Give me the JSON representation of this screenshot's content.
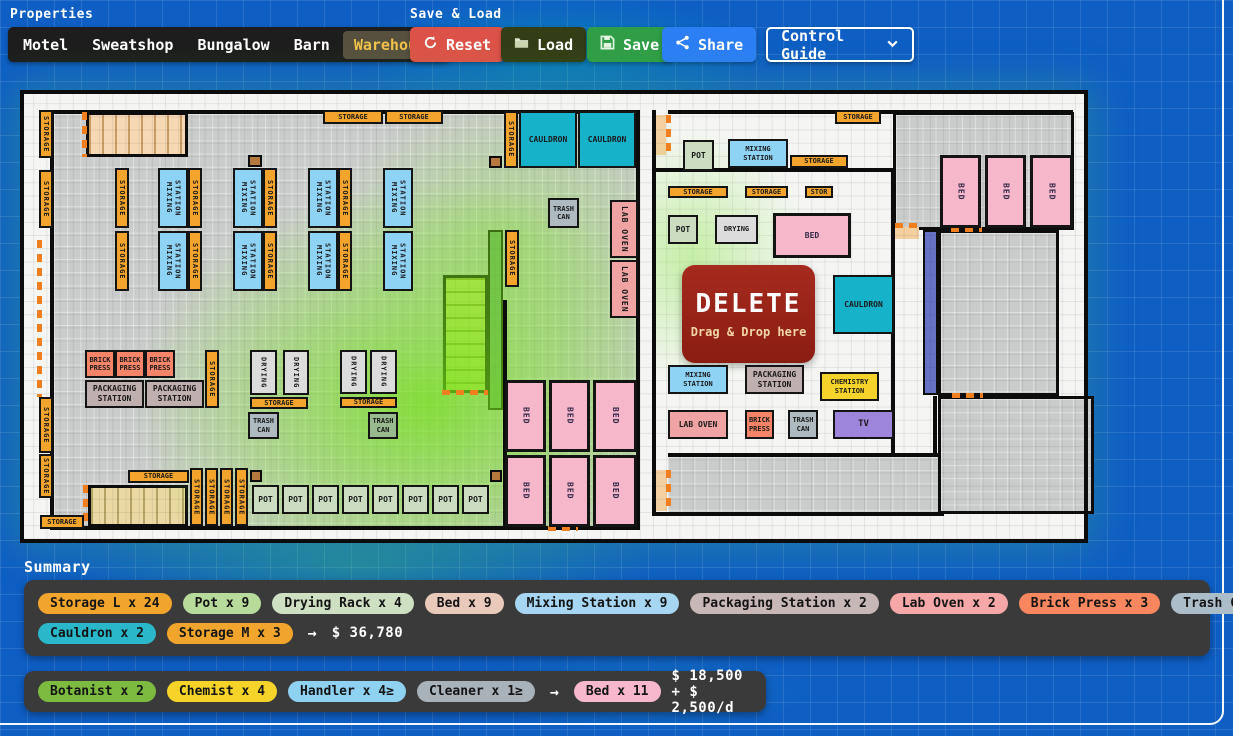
{
  "header": {
    "properties_label": "Properties",
    "save_load_label": "Save & Load",
    "control_guide": "Control Guide"
  },
  "tabs": {
    "active": "Warehouse",
    "items": [
      "Motel",
      "Sweatshop",
      "Bungalow",
      "Barn",
      "Warehouse"
    ]
  },
  "actions": {
    "reset": "Reset",
    "load": "Load",
    "save": "Save",
    "share": "Share"
  },
  "summary": {
    "title": "Summary",
    "arrow": "→",
    "items_row1": [
      [
        "Storage L x 24",
        "#f2a52d"
      ],
      [
        "Pot x 9",
        "#b6db9b"
      ],
      [
        "Drying Rack x 4",
        "#cfdfc2"
      ],
      [
        "Bed x 9",
        "#e9c9ba"
      ],
      [
        "Mixing Station x 9",
        "#a6d6f2"
      ],
      [
        "Packaging Station x 2",
        "#c8b7b7"
      ],
      [
        "Lab Oven x 2",
        "#f6a8a8"
      ],
      [
        "Brick Press x 3",
        "#f8865f"
      ],
      [
        "Trash Can x 3",
        "#aabdc9"
      ]
    ],
    "items_row2": [
      [
        "Cauldron x 2",
        "#2ab7c9"
      ],
      [
        "Storage M x 3",
        "#f2a52d"
      ]
    ],
    "total": "$ 36,780",
    "staff": [
      [
        "Botanist x 2",
        "#7dbb40"
      ],
      [
        "Chemist x 4",
        "#f5d328"
      ],
      [
        "Handler x 4≥",
        "#8ed1f1"
      ],
      [
        "Cleaner x 1≥",
        "#a9b1b9"
      ]
    ],
    "staff_bed": [
      "Bed x 11",
      "#f7b7cc"
    ],
    "staff_cost": "$ 18,500 + $ 2,500/d"
  },
  "plan": {
    "delete_zone": {
      "title": "DELETE",
      "subtitle": "Drag & Drop here",
      "x": 662,
      "y": 175,
      "w": 133,
      "h": 98
    },
    "zones": [
      [
        "z-grayL",
        34,
        24,
        582,
        412
      ],
      [
        "z-gray",
        873,
        22,
        181,
        118
      ],
      [
        "z-gray",
        918,
        140,
        121,
        166
      ],
      [
        "z-gray",
        918,
        306,
        156,
        118
      ],
      [
        "z-grayNB",
        648,
        367,
        274,
        56
      ],
      [
        "z-stairsP",
        66,
        22,
        102,
        45
      ],
      [
        "z-stairsG",
        423,
        185,
        45,
        118
      ],
      [
        "z-stairsT",
        68,
        395,
        100,
        42
      ],
      [
        "z-stripG",
        468,
        140,
        15,
        180
      ],
      [
        "z-stripP",
        903,
        140,
        15,
        165
      ],
      [
        "z-peach",
        633,
        25,
        13,
        40
      ],
      [
        "z-peach",
        875,
        137,
        24,
        12
      ],
      [
        "z-peach",
        633,
        380,
        14,
        41
      ],
      [
        "z-brown",
        228,
        65,
        14,
        12
      ],
      [
        "z-brown",
        469,
        66,
        13,
        12
      ],
      [
        "z-brown",
        230,
        380,
        12,
        12
      ],
      [
        "z-brown",
        470,
        380,
        12,
        12
      ]
    ],
    "walls": [
      [
        30,
        20,
        590,
        4
      ],
      [
        30,
        20,
        4,
        420
      ],
      [
        616,
        20,
        4,
        420
      ],
      [
        30,
        436,
        590,
        4
      ],
      [
        483,
        210,
        4,
        230
      ],
      [
        648,
        20,
        405,
        4
      ],
      [
        632,
        20,
        4,
        406
      ],
      [
        632,
        422,
        292,
        4
      ],
      [
        634,
        78,
        241,
        4
      ],
      [
        871,
        78,
        4,
        289
      ],
      [
        648,
        363,
        270,
        4
      ],
      [
        913,
        306,
        4,
        61
      ]
    ],
    "doors": [
      [
        62,
        22,
        5,
        45
      ],
      [
        17,
        150,
        5,
        157
      ],
      [
        63,
        395,
        5,
        40
      ],
      [
        646,
        25,
        5,
        40
      ],
      [
        646,
        380,
        5,
        41
      ],
      [
        422,
        300,
        46,
        5
      ],
      [
        528,
        436,
        30,
        5
      ],
      [
        875,
        133,
        24,
        5
      ],
      [
        931,
        137,
        31,
        5
      ],
      [
        932,
        303,
        31,
        5
      ]
    ],
    "items": [
      [
        "storage",
        "STORAGE",
        19,
        20,
        14,
        48,
        1
      ],
      [
        "storage",
        "STORAGE",
        19,
        80,
        14,
        58,
        1
      ],
      [
        "storage",
        "STORAGE",
        19,
        307,
        14,
        56,
        1
      ],
      [
        "storage",
        "STORAGE",
        19,
        364,
        14,
        44,
        1
      ],
      [
        "storage",
        "STORAGE",
        20,
        425,
        44,
        14,
        0
      ],
      [
        "storage",
        "STORAGE",
        303,
        20,
        60,
        14,
        0
      ],
      [
        "storage",
        "STORAGE",
        365,
        20,
        58,
        14,
        0
      ],
      [
        "storage",
        "STORAGE",
        95,
        78,
        14,
        60,
        1
      ],
      [
        "mixing",
        "MIXING\nSTATION",
        138,
        78,
        30,
        60,
        1
      ],
      [
        "storage",
        "STORAGE",
        168,
        78,
        14,
        60,
        1
      ],
      [
        "mixing",
        "MIXING\nSTATION",
        213,
        78,
        30,
        60,
        1
      ],
      [
        "storage",
        "STORAGE",
        243,
        78,
        14,
        60,
        1
      ],
      [
        "mixing",
        "MIXING\nSTATION",
        288,
        78,
        30,
        60,
        1
      ],
      [
        "storage",
        "STORAGE",
        318,
        78,
        14,
        60,
        1
      ],
      [
        "mixing",
        "MIXING\nSTATION",
        363,
        78,
        30,
        60,
        1
      ],
      [
        "storage",
        "STORAGE",
        95,
        141,
        14,
        60,
        1
      ],
      [
        "mixing",
        "MIXING\nSTATION",
        138,
        141,
        30,
        60,
        1
      ],
      [
        "storage",
        "STORAGE",
        168,
        141,
        14,
        60,
        1
      ],
      [
        "mixing",
        "MIXING\nSTATION",
        213,
        141,
        30,
        60,
        1
      ],
      [
        "storage",
        "STORAGE",
        243,
        141,
        14,
        60,
        1
      ],
      [
        "mixing",
        "MIXING\nSTATION",
        288,
        141,
        30,
        60,
        1
      ],
      [
        "storage",
        "STORAGE",
        318,
        141,
        14,
        60,
        1
      ],
      [
        "mixing",
        "MIXING\nSTATION",
        363,
        141,
        30,
        60,
        1
      ],
      [
        "storage",
        "STORAGE",
        484,
        21,
        14,
        57,
        1
      ],
      [
        "cauldron",
        "CAULDRON",
        499,
        21,
        58,
        57,
        0
      ],
      [
        "cauldron",
        "CAULDRON",
        558,
        21,
        58,
        57,
        0
      ],
      [
        "trash",
        "TRASH\nCAN",
        528,
        108,
        31,
        30,
        0
      ],
      [
        "laboven",
        "LAB OVEN",
        590,
        110,
        28,
        58,
        1
      ],
      [
        "laboven",
        "LAB OVEN",
        590,
        170,
        28,
        58,
        1
      ],
      [
        "storage",
        "STORAGE",
        485,
        140,
        14,
        57,
        1
      ],
      [
        "brickpress",
        "BRICK\nPRESS",
        65,
        260,
        30,
        28,
        0
      ],
      [
        "brickpress",
        "BRICK\nPRESS",
        95,
        260,
        30,
        28,
        0
      ],
      [
        "brickpress",
        "BRICK\nPRESS",
        125,
        260,
        30,
        28,
        0
      ],
      [
        "packaging",
        "PACKAGING\nSTATION",
        65,
        290,
        59,
        28,
        0
      ],
      [
        "packaging",
        "PACKAGING\nSTATION",
        125,
        290,
        59,
        28,
        0
      ],
      [
        "storage",
        "STORAGE",
        185,
        260,
        14,
        58,
        1
      ],
      [
        "drying",
        "DRYING",
        230,
        260,
        27,
        45,
        1
      ],
      [
        "drying",
        "DRYING",
        263,
        260,
        26,
        45,
        1
      ],
      [
        "storage",
        "STORAGE",
        230,
        307,
        58,
        12,
        0
      ],
      [
        "trash",
        "TRASH\nCAN",
        228,
        322,
        31,
        27,
        0
      ],
      [
        "drying",
        "DRYING",
        320,
        260,
        27,
        44,
        1
      ],
      [
        "drying",
        "DRYING",
        350,
        260,
        27,
        44,
        1
      ],
      [
        "storage",
        "STORAGE",
        320,
        307,
        57,
        11,
        0
      ],
      [
        "trashg",
        "TRASH\nCAN",
        348,
        322,
        30,
        27,
        0
      ],
      [
        "storage",
        "STORAGE",
        108,
        380,
        61,
        13,
        0
      ],
      [
        "storage",
        "STORAGE",
        170,
        378,
        13,
        58,
        1
      ],
      [
        "storage",
        "STORAGE",
        185,
        378,
        13,
        58,
        1
      ],
      [
        "storage",
        "STORAGE",
        200,
        378,
        13,
        58,
        1
      ],
      [
        "storage",
        "STORAGE",
        215,
        378,
        13,
        58,
        1
      ],
      [
        "pot",
        "POT",
        232,
        395,
        27,
        29,
        0
      ],
      [
        "pot",
        "POT",
        262,
        395,
        27,
        29,
        0
      ],
      [
        "pot",
        "POT",
        292,
        395,
        27,
        29,
        0
      ],
      [
        "pot",
        "POT",
        322,
        395,
        27,
        29,
        0
      ],
      [
        "pot",
        "POT",
        352,
        395,
        27,
        29,
        0
      ],
      [
        "pot",
        "POT",
        382,
        395,
        27,
        29,
        0
      ],
      [
        "pot",
        "POT",
        412,
        395,
        27,
        29,
        0
      ],
      [
        "pot",
        "POT",
        442,
        395,
        27,
        29,
        0
      ],
      [
        "bed",
        "BED",
        485,
        290,
        41,
        72,
        1
      ],
      [
        "bed",
        "BED",
        529,
        290,
        41,
        72,
        1
      ],
      [
        "bed",
        "BED",
        573,
        290,
        44,
        72,
        1
      ],
      [
        "bed",
        "BED",
        485,
        365,
        41,
        72,
        1
      ],
      [
        "bed",
        "BED",
        529,
        365,
        41,
        72,
        1
      ],
      [
        "bed",
        "BED",
        573,
        365,
        44,
        72,
        1
      ],
      [
        "storage",
        "STORAGE",
        815,
        20,
        46,
        14,
        0
      ],
      [
        "pot",
        "POT",
        663,
        50,
        31,
        31,
        0
      ],
      [
        "mixing",
        "MIXING\nSTATION",
        708,
        49,
        60,
        29,
        0
      ],
      [
        "storage",
        "STORAGE",
        770,
        65,
        58,
        13,
        0
      ],
      [
        "storage",
        "STORAGE",
        648,
        96,
        60,
        12,
        0
      ],
      [
        "storage",
        "STORAGE",
        725,
        96,
        43,
        12,
        0
      ],
      [
        "stor",
        "STOR",
        785,
        96,
        28,
        12,
        0
      ],
      [
        "pot",
        "POT",
        648,
        125,
        30,
        29,
        0
      ],
      [
        "drying",
        "DRYING",
        695,
        125,
        43,
        29,
        0
      ],
      [
        "bed",
        "BED",
        753,
        123,
        78,
        45,
        0
      ],
      [
        "cauldron",
        "CAULDRON",
        813,
        185,
        61,
        59,
        0
      ],
      [
        "mixing",
        "MIXING\nSTATION",
        648,
        275,
        60,
        29,
        0
      ],
      [
        "packaging",
        "PACKAGING\nSTATION",
        725,
        275,
        59,
        29,
        0
      ],
      [
        "chemistry",
        "CHEMISTRY\nSTATION",
        800,
        282,
        59,
        29,
        0
      ],
      [
        "laboven",
        "LAB OVEN",
        648,
        320,
        60,
        29,
        0
      ],
      [
        "brickpress",
        "BRICK\nPRESS",
        725,
        320,
        29,
        29,
        0
      ],
      [
        "trash",
        "TRASH\nCAN",
        768,
        320,
        30,
        29,
        0
      ],
      [
        "tv",
        "TV",
        813,
        320,
        61,
        29,
        0
      ],
      [
        "bed",
        "BED",
        920,
        65,
        41,
        73,
        1
      ],
      [
        "bed",
        "BED",
        965,
        65,
        41,
        73,
        1
      ],
      [
        "bed",
        "BED",
        1010,
        65,
        43,
        73,
        1
      ]
    ]
  }
}
